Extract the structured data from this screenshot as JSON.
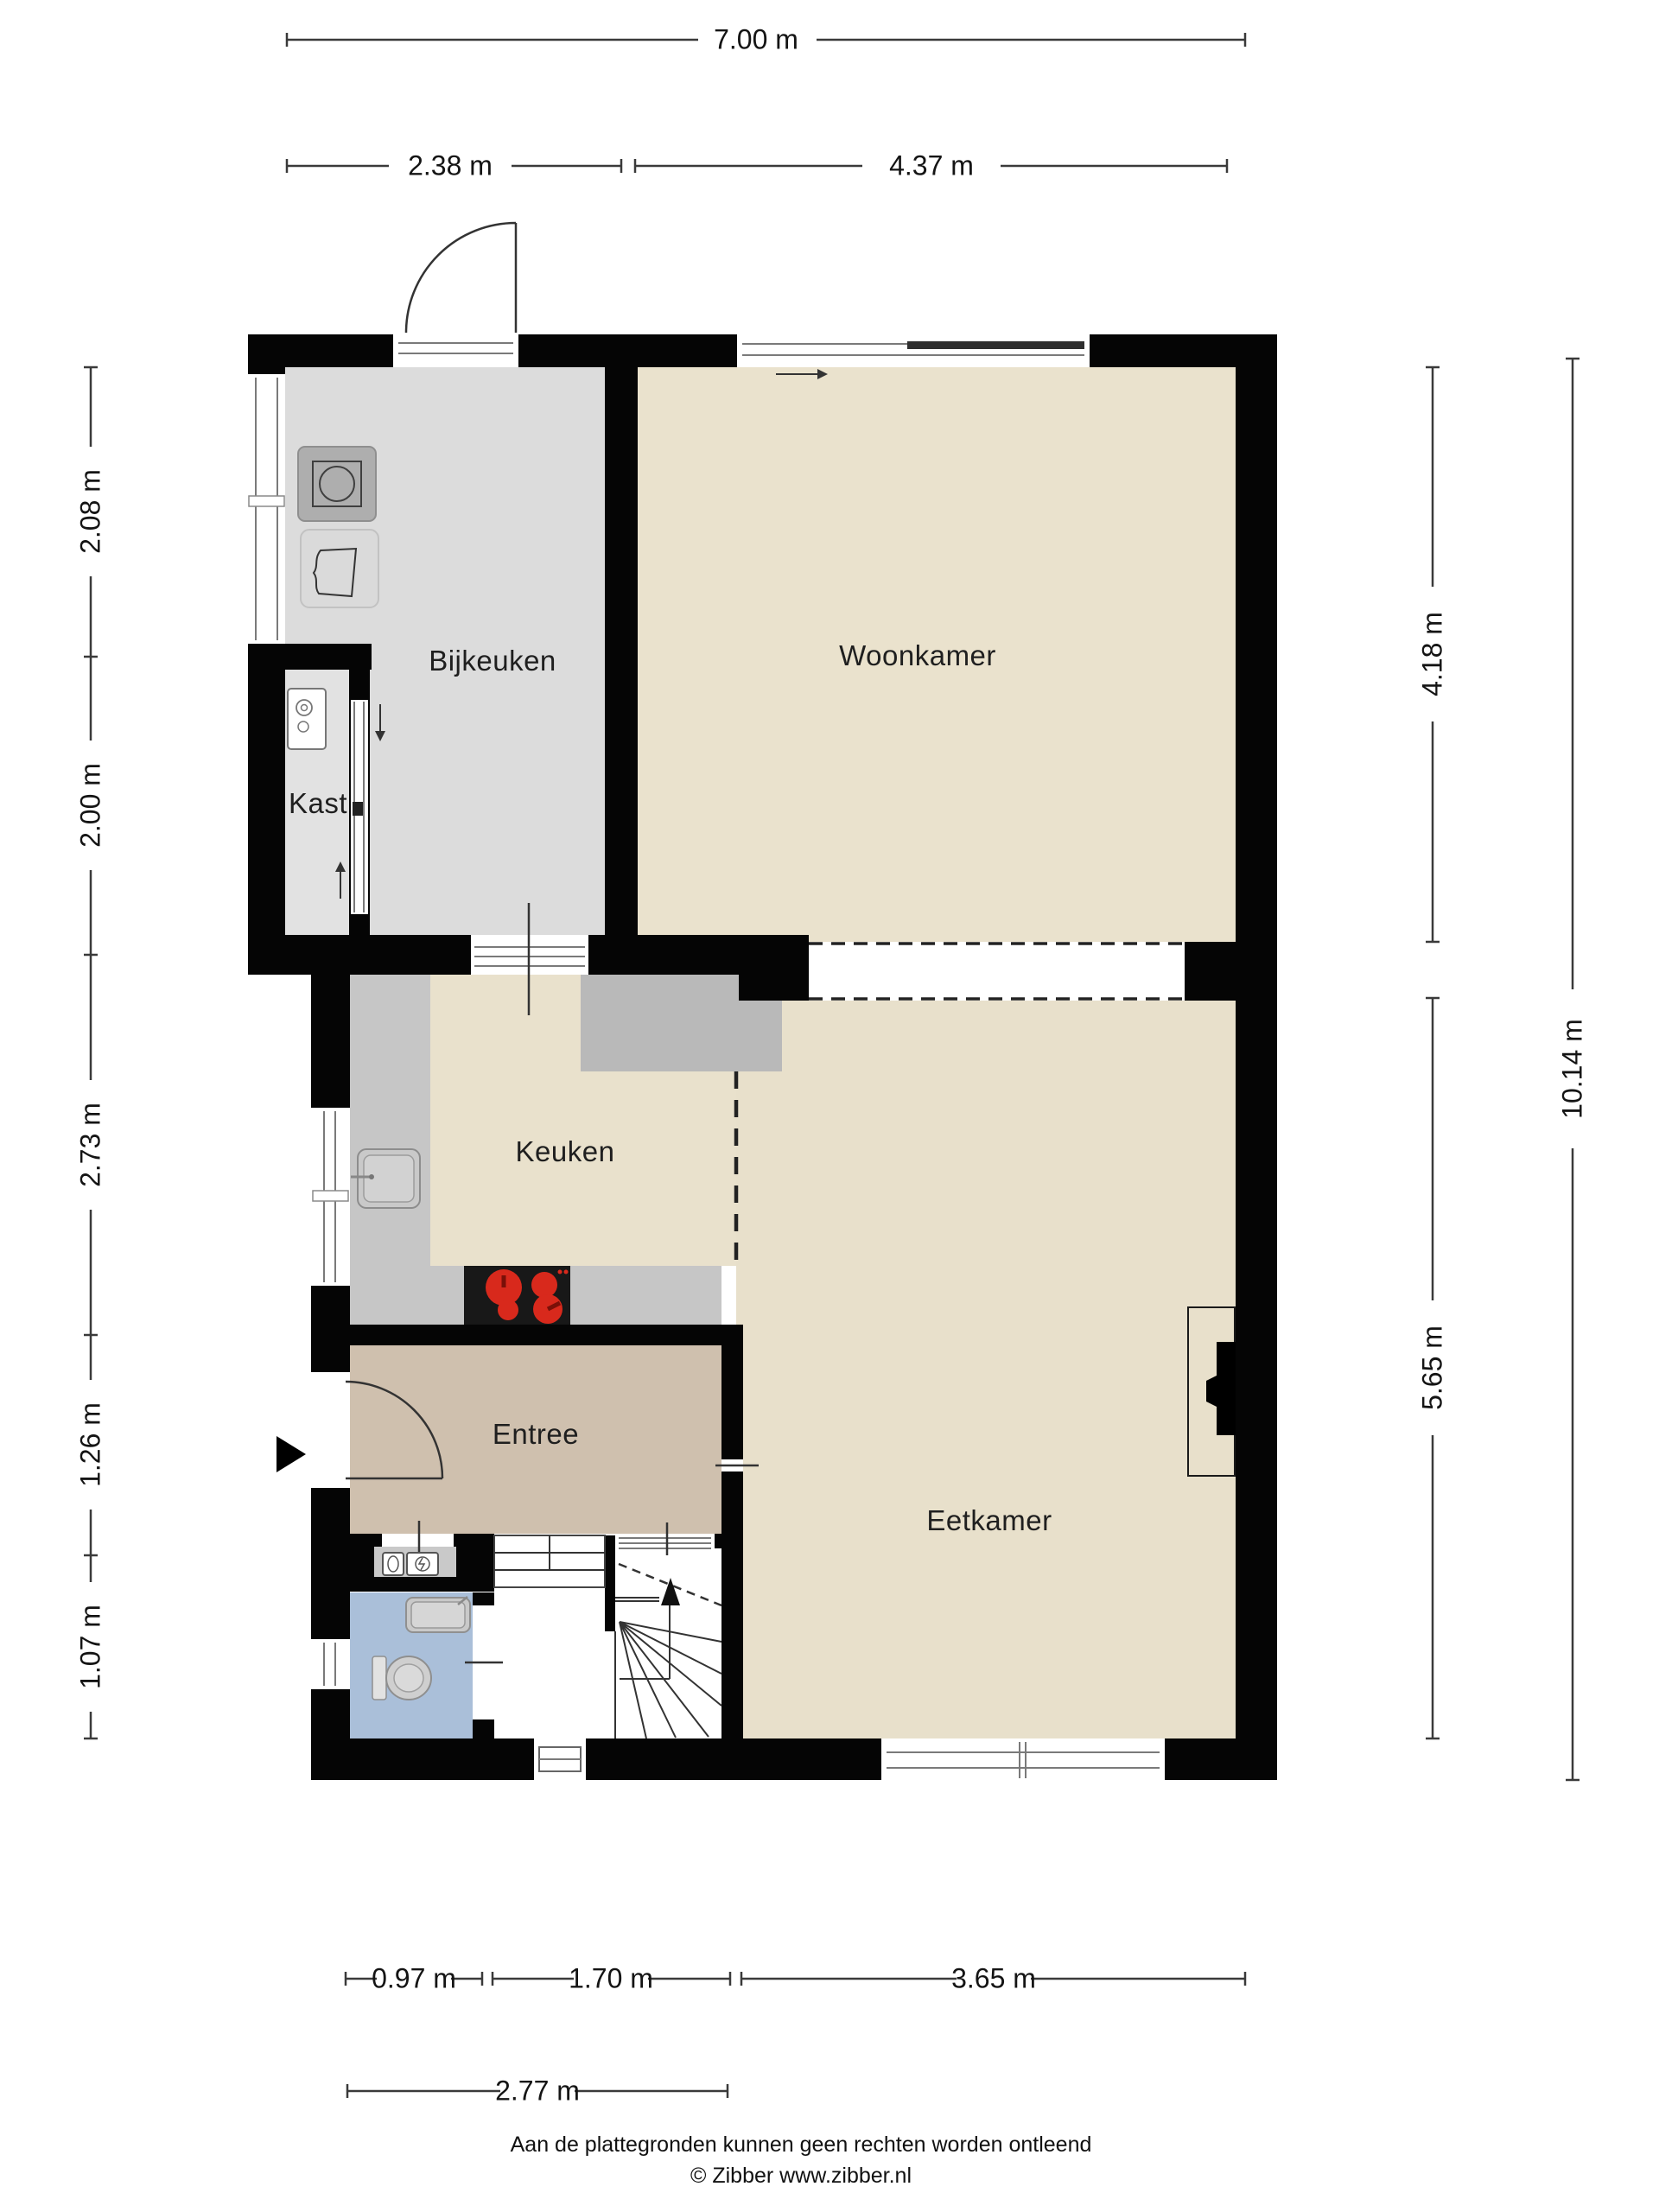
{
  "rooms": {
    "bijkeuken": {
      "label": "Bijkeuken"
    },
    "woonkamer": {
      "label": "Woonkamer"
    },
    "kast": {
      "label": "Kast"
    },
    "keuken": {
      "label": "Keuken"
    },
    "entree": {
      "label": "Entree"
    },
    "eetkamer": {
      "label": "Eetkamer"
    }
  },
  "dimensions": {
    "top_total": {
      "label": "7.00 m"
    },
    "top_left": {
      "label": "2.38 m"
    },
    "top_right": {
      "label": "4.37 m"
    },
    "left": [
      {
        "label": "2.08 m"
      },
      {
        "label": "2.00 m"
      },
      {
        "label": "2.73 m"
      },
      {
        "label": "1.26 m"
      },
      {
        "label": "1.07 m"
      }
    ],
    "right_inner": [
      {
        "label": "4.18 m"
      },
      {
        "label": "5.65 m"
      }
    ],
    "right_outer": {
      "label": "10.14 m"
    },
    "bottom": [
      {
        "label": "0.97 m"
      },
      {
        "label": "1.70 m"
      },
      {
        "label": "3.65 m"
      }
    ],
    "bottom_second": {
      "label": "2.77 m"
    }
  },
  "footer": {
    "disclaimer": "Aan de plattegronden kunnen geen rechten worden ontleend",
    "credit": "© Zibber www.zibber.nl"
  },
  "icons": {
    "washing_machine": "washing-machine-icon",
    "laundry_basket": "laundry-basket-icon",
    "boiler": "boiler-icon",
    "kitchen_sink": "kitchen-sink-icon",
    "stove": "stove-icon",
    "bathroom_sink": "bathroom-sink-icon",
    "toilet": "toilet-icon",
    "meters": "utility-meter-icons",
    "stairs": "stairs-icon",
    "entrance_arrow": "entrance-arrow-icon"
  },
  "colors": {
    "wall": "#050505",
    "bijkeuken_floor": "#dcdcdc",
    "kast_floor": "#e2e2e2",
    "living_floor": "#eae2cd",
    "kitchen_floor": "#e9e1cc",
    "eetkamer_floor": "#e8e0cb",
    "counter": "#c6c6c6",
    "counter_dark": "#b9b9b9",
    "entree_floor": "#cfc0ae",
    "bathroom_floor": "#aabfd9",
    "stove_black": "#181818",
    "burner_red": "#d8291c",
    "dim_line": "#3a3a3a"
  }
}
